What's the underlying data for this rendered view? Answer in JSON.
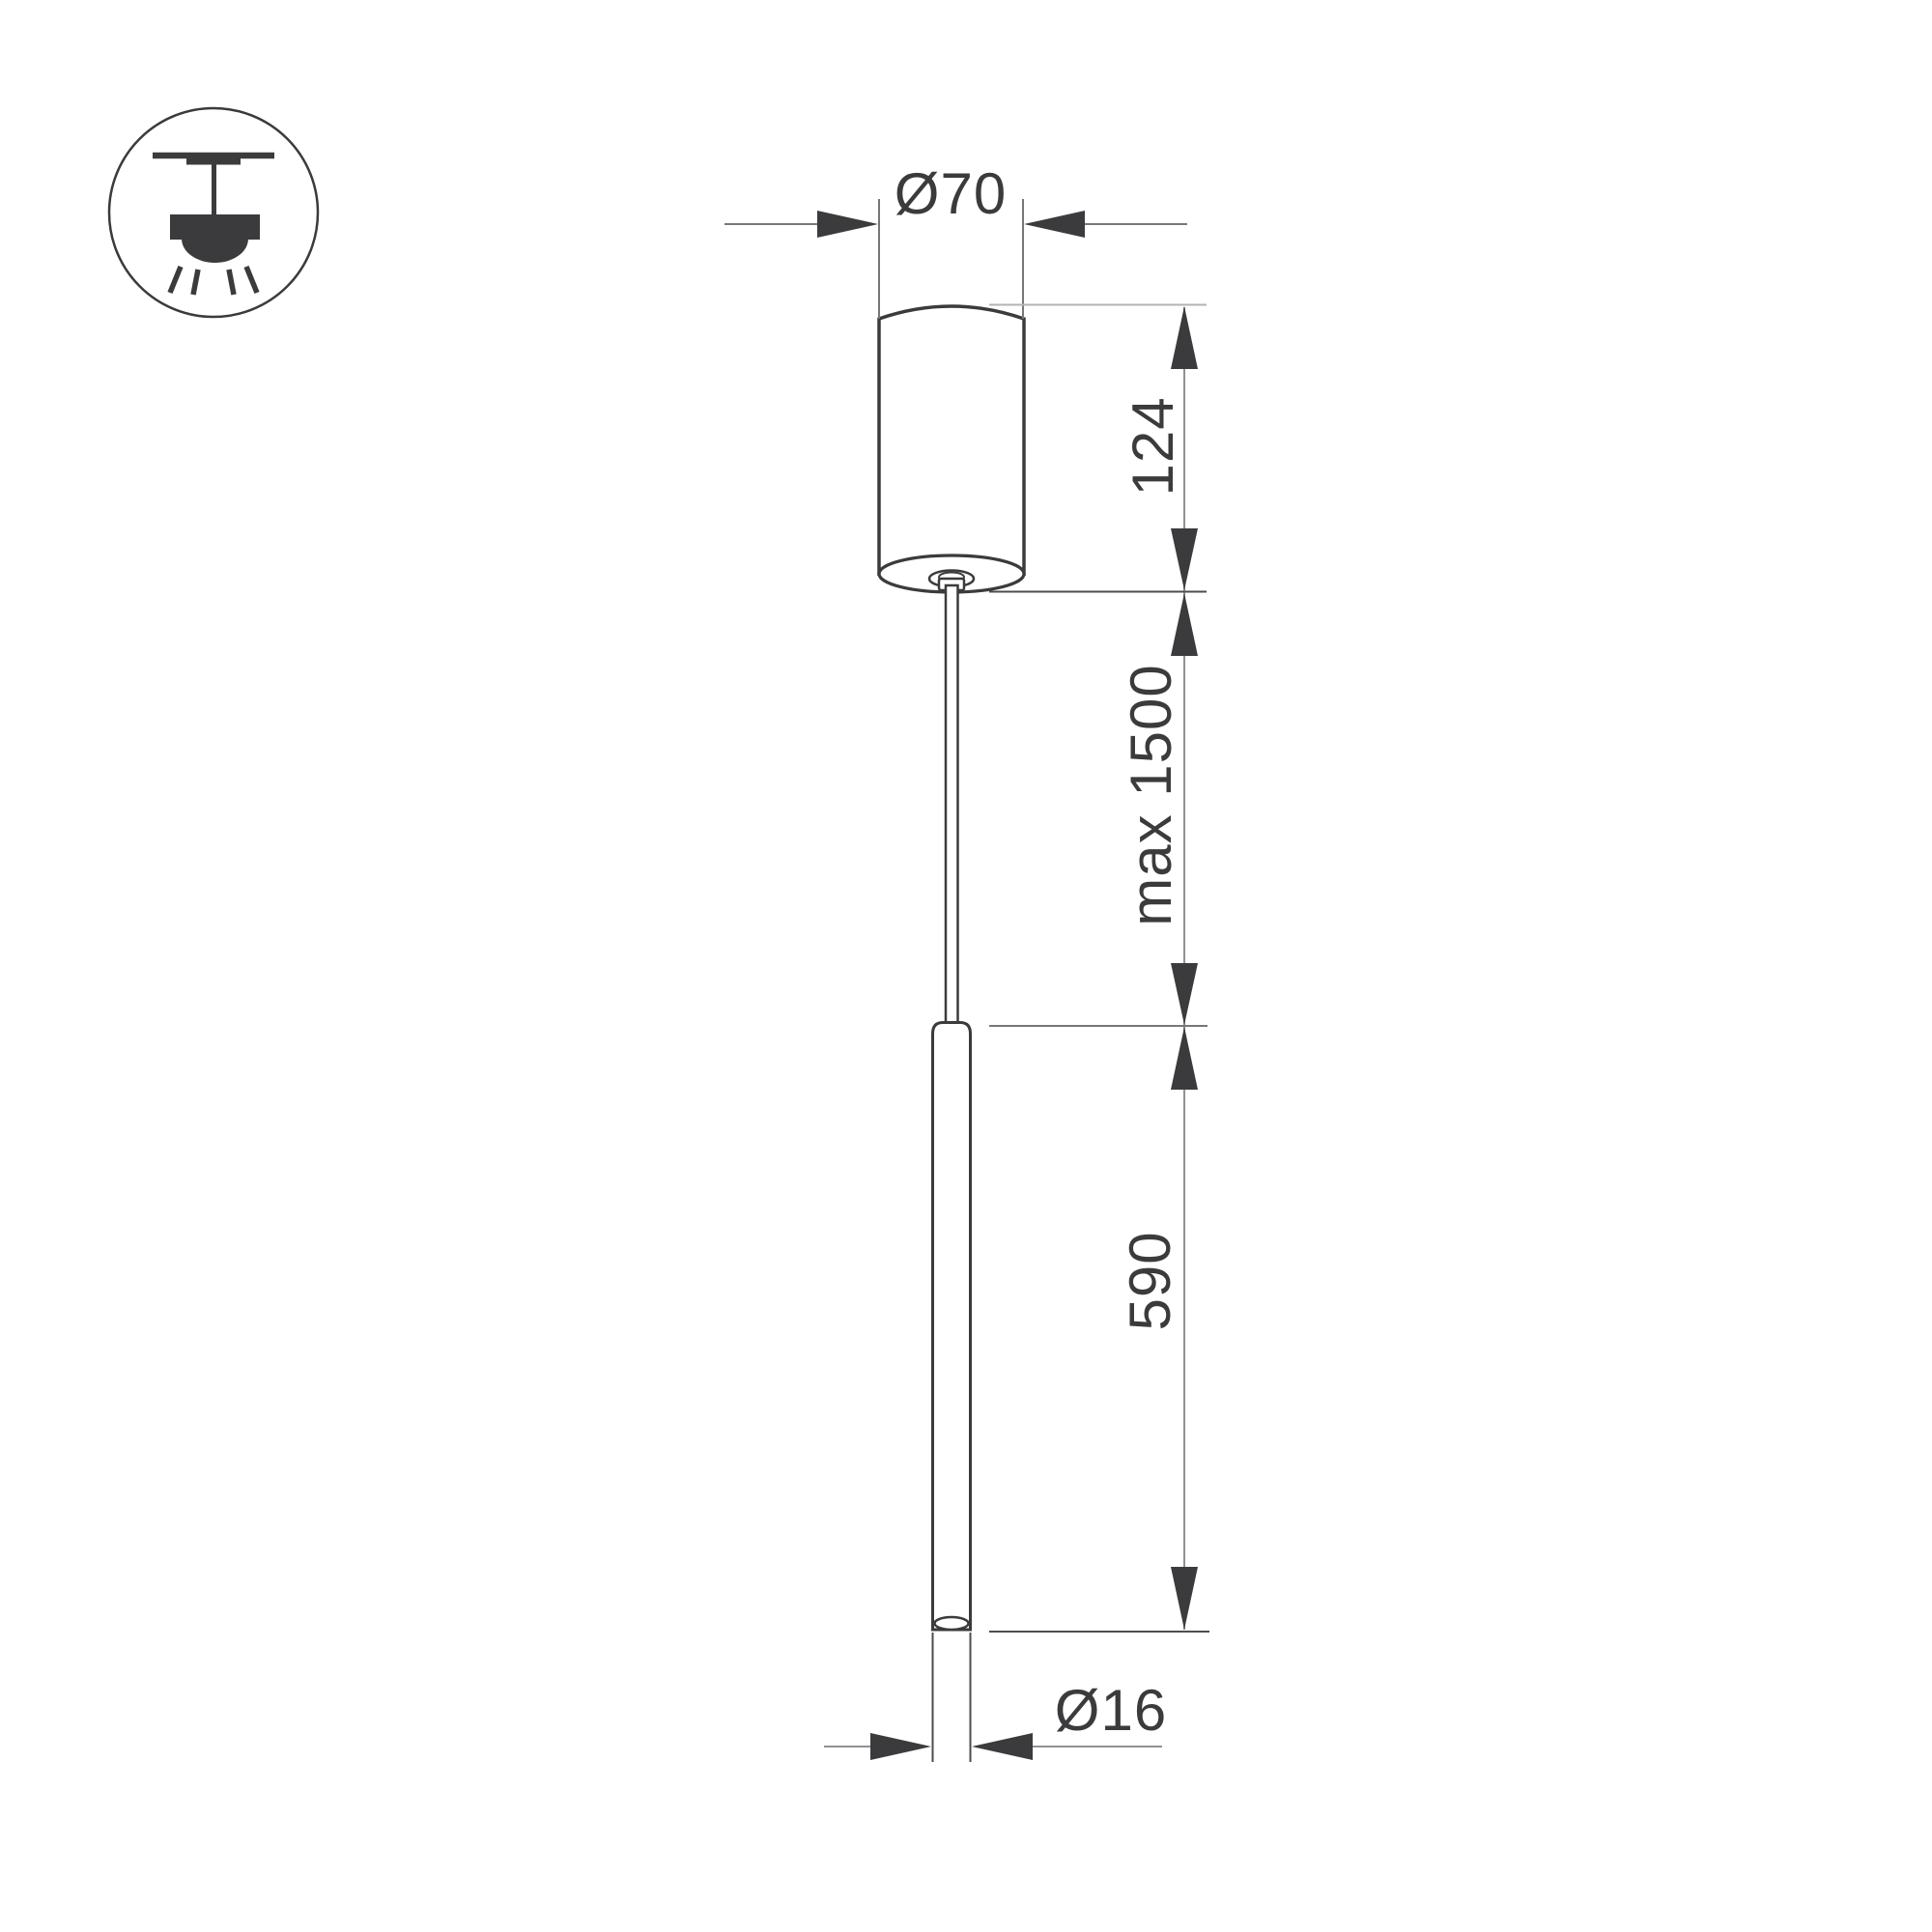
{
  "page": {
    "background": "#ffffff"
  },
  "icon": {
    "semantic": "pendant-light-ceiling-mount-icon"
  },
  "dimensions": {
    "canopy_diameter": "Ø70",
    "canopy_height": "124",
    "suspension_max": "max 1500",
    "tube_length": "590",
    "tube_diameter": "Ø16"
  },
  "colors": {
    "outline": "#3b3b3d",
    "dim": "#919194",
    "ext_dark": "#4d4d50",
    "ext_mid": "#77777a",
    "ext_light": "#b3b3b5",
    "bg": "#ffffff"
  }
}
